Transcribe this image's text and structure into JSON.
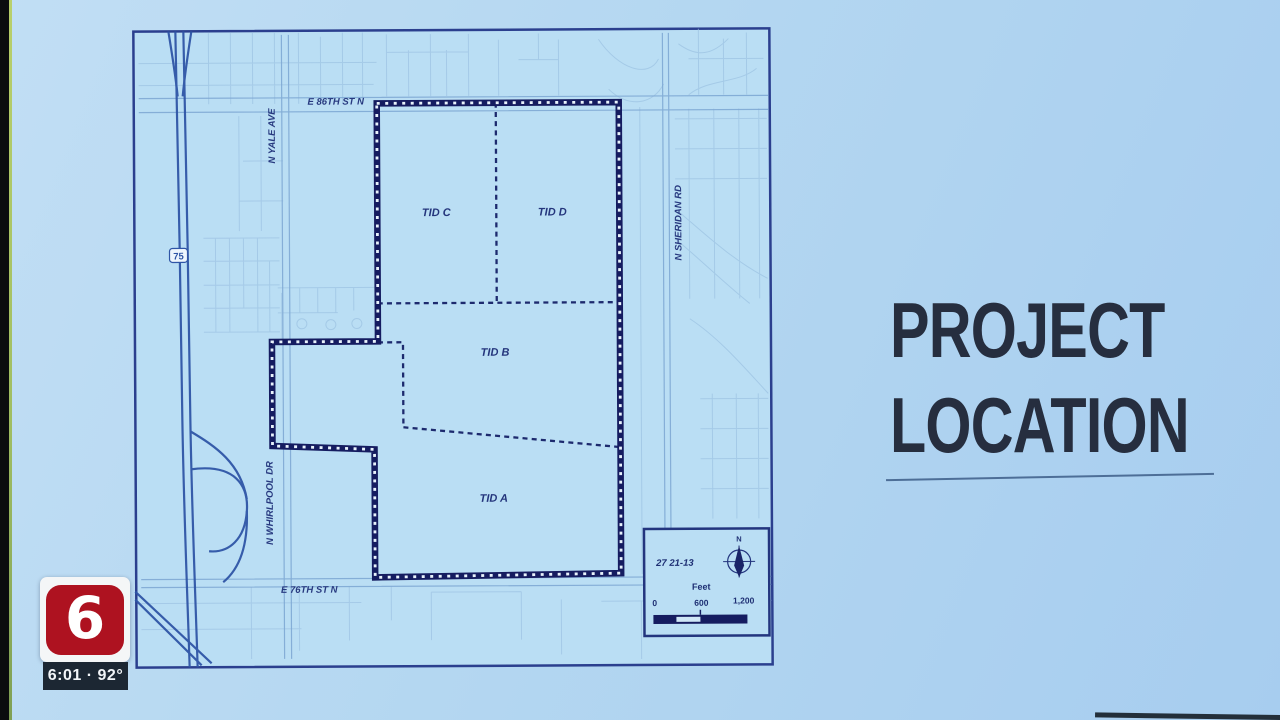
{
  "slide": {
    "title_line1": "PROJECT",
    "title_line2": "LOCATION"
  },
  "map": {
    "streets": {
      "e86": "E 86TH ST N",
      "yale": "N YALE AVE",
      "sheridan": "N SHERIDAN RD",
      "whirlpool": "N WHIRLPOOL DR",
      "e76": "E 76TH ST N"
    },
    "highway_shield": "75",
    "tids": {
      "a": "TID A",
      "b": "TID B",
      "c": "TID C",
      "d": "TID D"
    },
    "legend": {
      "section": "27 21-13",
      "north": "N",
      "unit": "Feet",
      "tick0": "0",
      "tick600": "600",
      "tick1200": "1,200"
    }
  },
  "broadcast": {
    "station": "6",
    "ticker": "6:01 · 92°"
  },
  "colors": {
    "slide_bg": "#b4d7f1",
    "map_frame": "#2b3f8e",
    "boundary": "#151c60",
    "highway": "#2f55a6",
    "title_text": "#262e3f",
    "logo_red": "#ae1220",
    "ticker_bg": "#1c2733"
  }
}
